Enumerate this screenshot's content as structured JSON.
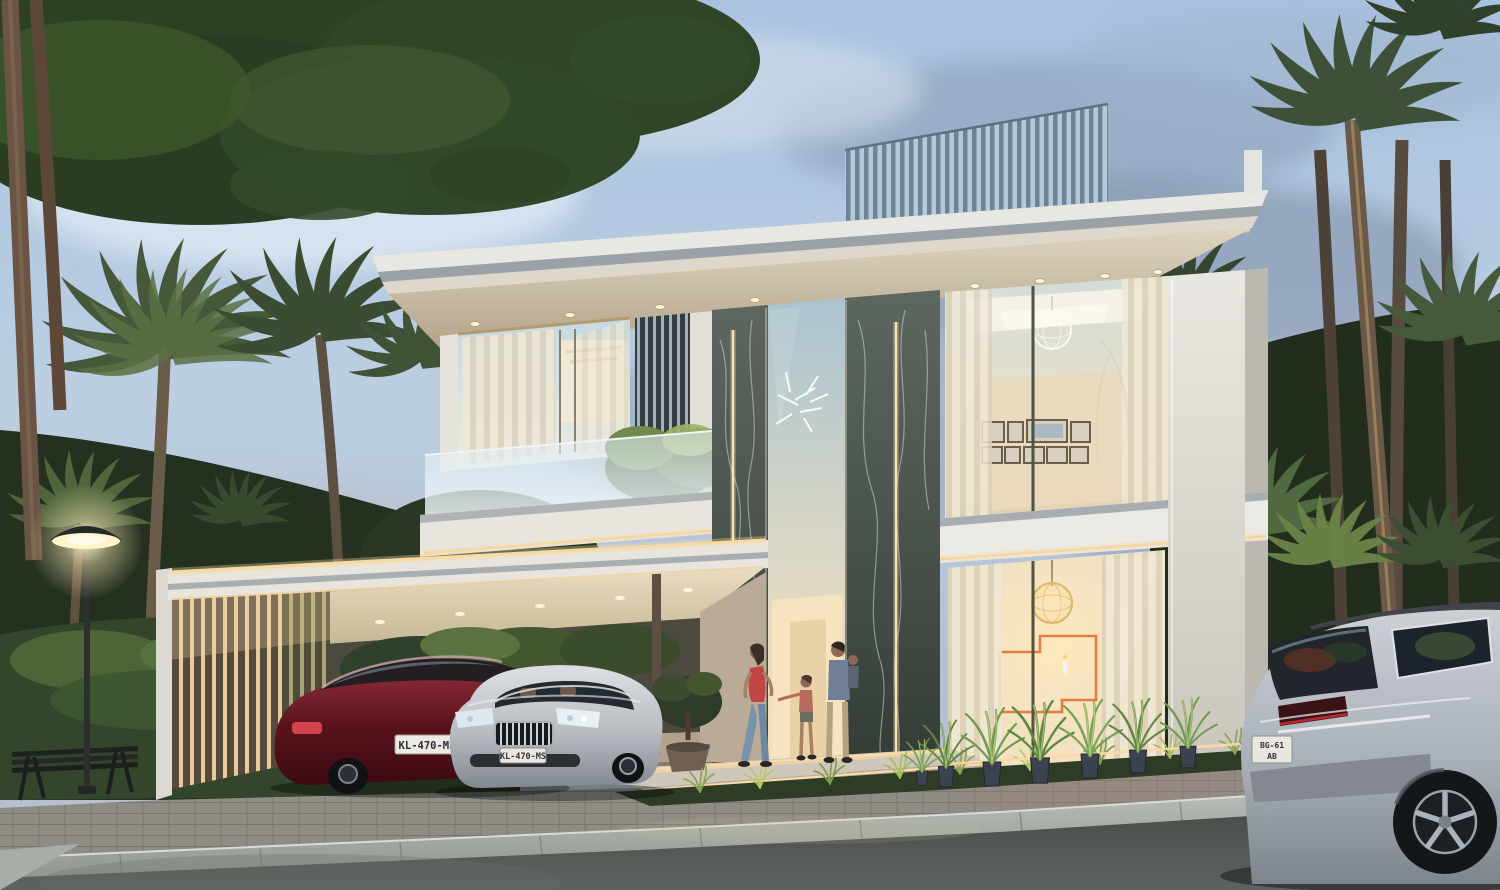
{
  "scene": {
    "time_of_day": "dusk",
    "subject": "modern two-storey luxury villa exterior render"
  },
  "vehicles": {
    "red_sedan": {
      "plate": "KL-470-MS",
      "body_color": "#5e1420"
    },
    "silver_sedan": {
      "plate": "KL-470-MS",
      "body_color": "#b9bec4"
    },
    "suv": {
      "plate": "BG-61-AB",
      "plate_line1": "BG-61",
      "plate_line2": "AB",
      "body_color": "#b6bcc2"
    }
  },
  "palette": {
    "sky_top": "#a9c2e0",
    "sky_cloud": "#76869d",
    "facade_white": "#e9e7e2",
    "soffit_cream": "#d8cdb7",
    "led_warm": "#f6d8a2",
    "marble_dark": "#49524b",
    "roof_louver": "#6d8496",
    "foliage_dark": "#2c4024",
    "foliage_lit": "#8aa864",
    "road_asphalt": "#4f5350",
    "curb_stone": "#b8bfb9",
    "artwork_orange": "#e0763c"
  }
}
